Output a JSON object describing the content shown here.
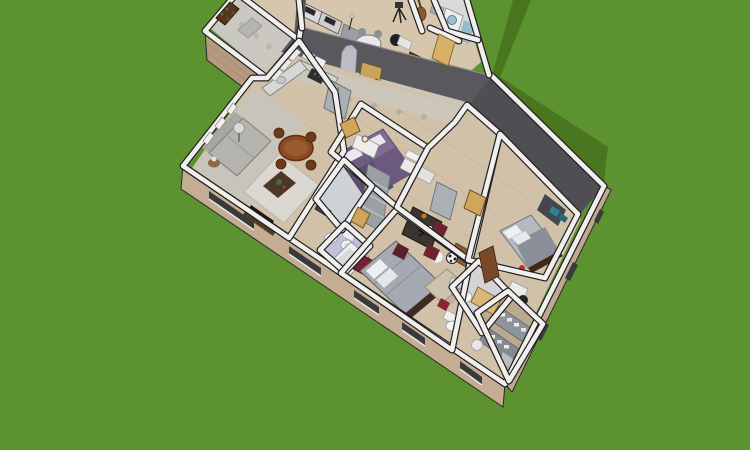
{
  "scene": {
    "type": "3d-floorplan-cutaway-render",
    "view": "aerial isometric dollhouse view of a single-story house on a lawn",
    "background": {
      "grass_color": "#5c9230",
      "shadow_color": "#4a761f"
    },
    "palette": {
      "wall_top": "#f1efeb",
      "wall_edge": "#1f1f22",
      "facade_tan": "#c4ad92",
      "facade_tan_dark": "#b69a80",
      "tall_wall_grey": "#59595d",
      "tall_wall_right": "#4f4f53",
      "wallpaper_trim": "#ccc6ba",
      "wood_floor": "#d0c1a8",
      "wood_floor_upper": "#d5c6ad",
      "carpet": "#c7c4bb",
      "tile": "#cdd2d6",
      "lavender_floor": "#c3bfdd",
      "closet_floor": "#b9a98f",
      "door_tan": "#d2a55c",
      "front_door_brown": "#58351c",
      "purple_bed": "#6e5d80",
      "purple_bed_2": "#7e6c92",
      "grey_bed": "#a5aab2",
      "red_accent": "#77202e",
      "sofa_grey": "#b5b3ae",
      "sofa_beige": "#cdc2ab",
      "dining_wood": "#8a4a22",
      "fridge_steel": "#aab0b4",
      "shelf_grey": "#8f949a",
      "teal_accent": "#2e8496"
    },
    "wings": [
      "main-wing",
      "upper-wing",
      "entrance-porch"
    ],
    "rooms": [
      {
        "name": "entrance-hall",
        "floor": "tile",
        "furniture": [
          "front-door-with-green-stained-glass",
          "doormat"
        ]
      },
      {
        "name": "studio",
        "floor": "wood",
        "furniture": [
          "desk-units",
          "monitors",
          "round-table",
          "grey-chairs",
          "office-chair",
          "camera-tripod",
          "guitar",
          "mic-stand"
        ]
      },
      {
        "name": "office",
        "floor": "wood",
        "furniture": [
          "wooden-desk",
          "office-chair",
          "wall-shelf",
          "door",
          "rug"
        ]
      },
      {
        "name": "laundry-bath",
        "floor": "tile",
        "furniture": [
          "washing-machine",
          "shelves",
          "glass-screen"
        ]
      },
      {
        "name": "living-dining-room",
        "floor": "carpet-and-wood",
        "furniture": [
          "grey-sofa",
          "area-rug",
          "coffee-table-with-plant",
          "tv-cabinet",
          "floor-lamp",
          "side-table-lamp",
          "wall-pictures",
          "round-dining-table",
          "four-wood-chairs"
        ]
      },
      {
        "name": "kitchen",
        "floor": "wood",
        "furniture": [
          "l-shaped-counter",
          "upper-cabinets",
          "stove",
          "sink",
          "refrigerator"
        ]
      },
      {
        "name": "bedroom-1",
        "floor": "wood",
        "furniture": [
          "twin-bed-purple",
          "twin-bed-purple-2",
          "white-nightstand",
          "table-lamp",
          "door"
        ]
      },
      {
        "name": "bathroom-1",
        "floor": "tile",
        "furniture": [
          "toilet",
          "pedestal-sink",
          "mirror",
          "dark-shelf",
          "door"
        ]
      },
      {
        "name": "bathroom-lavender",
        "floor": "lavender",
        "furniture": [
          "bathtub"
        ]
      },
      {
        "name": "master-bedroom",
        "floor": "wood",
        "furniture": [
          "double-bed-grey",
          "white-pillows",
          "red-bench",
          "beige-sofa",
          "paper-lantern-lamp",
          "wood-dresser"
        ]
      },
      {
        "name": "second-kitchen-dining",
        "floor": "wood",
        "furniture": [
          "shelving-unit",
          "upper-cabinets",
          "counter",
          "refrigerator",
          "dark-dining-table",
          "maroon-chairs",
          "football",
          "door"
        ]
      },
      {
        "name": "bedroom-3",
        "floor": "wood",
        "furniture": [
          "bed-walnut-frame",
          "white-pillows",
          "dark-wardrobe-teal-boxes",
          "white-desk",
          "black-chair",
          "open-wood-door"
        ]
      },
      {
        "name": "bathroom-2",
        "floor": "tile",
        "furniture": [
          "toilet",
          "pedestal-sink",
          "wood-vanity",
          "red-stool",
          "mirror"
        ]
      },
      {
        "name": "walk-in-closet",
        "floor": "wood",
        "furniture": [
          "shelving-with-folded-clothes",
          "second-shelf",
          "laundry-basket",
          "hanging-clothes"
        ]
      }
    ],
    "features": [
      "cast-shadow-on-grass-northeast",
      "tall-grey-interior-wall-with-arch-and-door",
      "facade-window-slits",
      "cutaway-white-wall-tops"
    ]
  }
}
